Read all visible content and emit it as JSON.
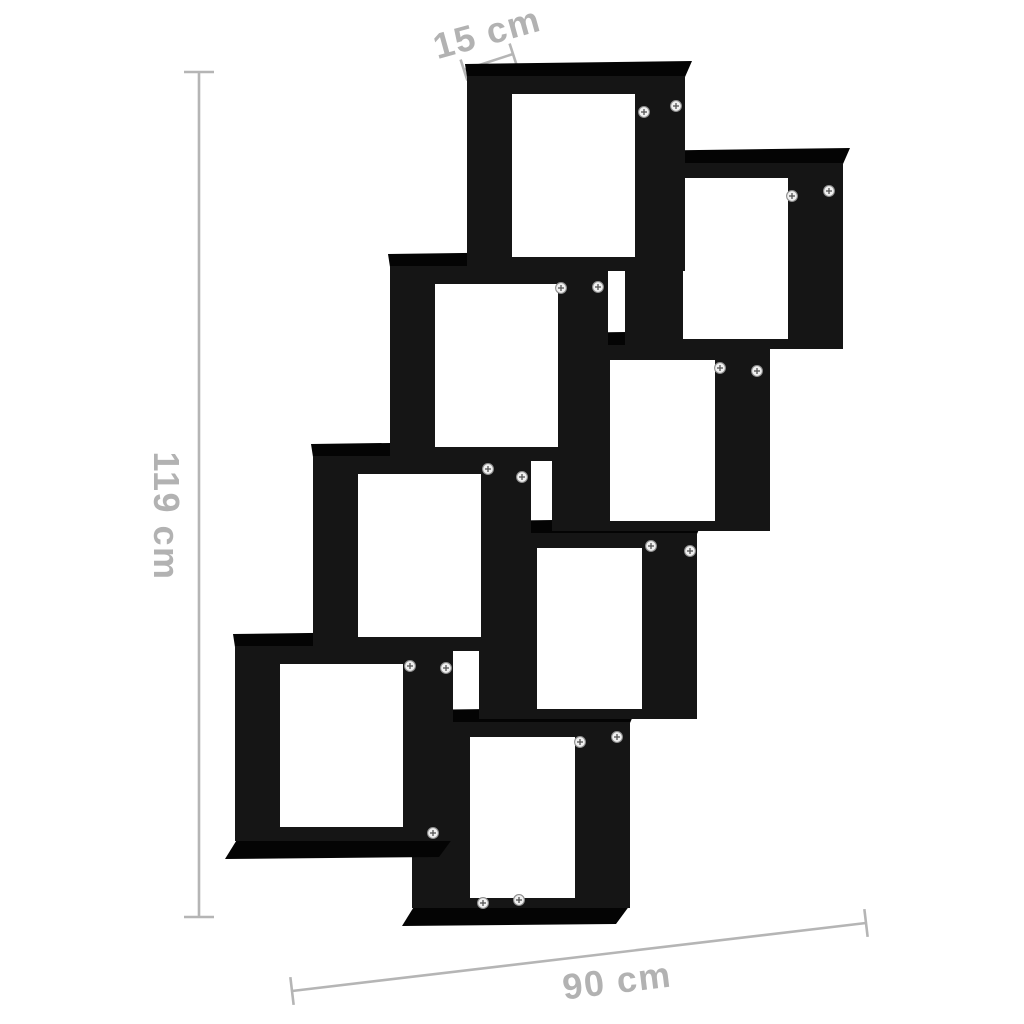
{
  "image": {
    "description": "Product dimension diagram of a black wall-mounted cube shelf with 8 staggered square compartments arranged in a descending zigzag",
    "background_color": "#ffffff"
  },
  "dimensions": {
    "depth_label": "15 cm",
    "height_label": "119 cm",
    "width_label": "90 cm"
  },
  "style": {
    "dimension_color": "#b5b5b5",
    "label_color": "#b2b2b2",
    "shelf_front_color": "#151515",
    "shelf_face_color": "#040404",
    "interior_color": "#ffffff",
    "screw_fill": "#f0f0f0",
    "screw_ring": "#8f8f8f",
    "screw_slot": "#555555"
  },
  "shelf": {
    "cube_count": 8,
    "chains": {
      "left_chain": {
        "w": 218,
        "h": 195,
        "inset_top": 18,
        "inset_right": 50,
        "inset_bottom": 14,
        "inset_left": 45
      },
      "right_chain": {
        "w": 218,
        "h": 186,
        "inset_top": 15,
        "inset_right": 55,
        "inset_bottom": 10,
        "inset_left": 58
      }
    },
    "cubes": [
      {
        "id": "bottom-center",
        "chain": "right_chain",
        "x": 412,
        "y": 722,
        "foot": true
      },
      {
        "id": "mid-low-right",
        "chain": "right_chain",
        "x": 479,
        "y": 533,
        "foot": false
      },
      {
        "id": "mid-right",
        "chain": "right_chain",
        "x": 552,
        "y": 345,
        "foot": false
      },
      {
        "id": "top-right",
        "chain": "right_chain",
        "x": 625,
        "y": 163,
        "foot": false
      },
      {
        "id": "bottom-left",
        "chain": "left_chain",
        "x": 235,
        "y": 646,
        "foot": true
      },
      {
        "id": "mid-low-left",
        "chain": "left_chain",
        "x": 313,
        "y": 456,
        "foot": false
      },
      {
        "id": "mid-left",
        "chain": "left_chain",
        "x": 390,
        "y": 266,
        "foot": false
      },
      {
        "id": "top-center",
        "chain": "left_chain",
        "x": 467,
        "y": 76,
        "foot": false
      }
    ],
    "screws": [
      [
        644,
        112
      ],
      [
        676,
        106
      ],
      [
        792,
        196
      ],
      [
        829,
        191
      ],
      [
        561,
        288
      ],
      [
        598,
        287
      ],
      [
        720,
        368
      ],
      [
        757,
        371
      ],
      [
        488,
        469
      ],
      [
        522,
        477
      ],
      [
        651,
        546
      ],
      [
        690,
        551
      ],
      [
        410,
        666
      ],
      [
        446,
        668
      ],
      [
        580,
        742
      ],
      [
        617,
        737
      ],
      [
        433,
        833
      ],
      [
        483,
        903
      ],
      [
        519,
        900
      ]
    ]
  },
  "dimension_lines": [
    {
      "name": "height-dimension-line",
      "from": [
        199,
        72
      ],
      "to": [
        199,
        917
      ],
      "tick": 15
    },
    {
      "name": "depth-dimension-line",
      "from": [
        464,
        70
      ],
      "to": [
        513,
        54
      ],
      "tick": 11
    },
    {
      "name": "width-dimension-line",
      "from": [
        292,
        991
      ],
      "to": [
        866,
        923
      ],
      "tick": 14
    }
  ],
  "labels": {
    "depth": {
      "cx": 487,
      "cy": 33,
      "angle": -15.5
    },
    "height": {
      "cx": 166,
      "cy": 516,
      "angle": 90
    },
    "width": {
      "cx": 617,
      "cy": 981,
      "angle": -7
    }
  }
}
